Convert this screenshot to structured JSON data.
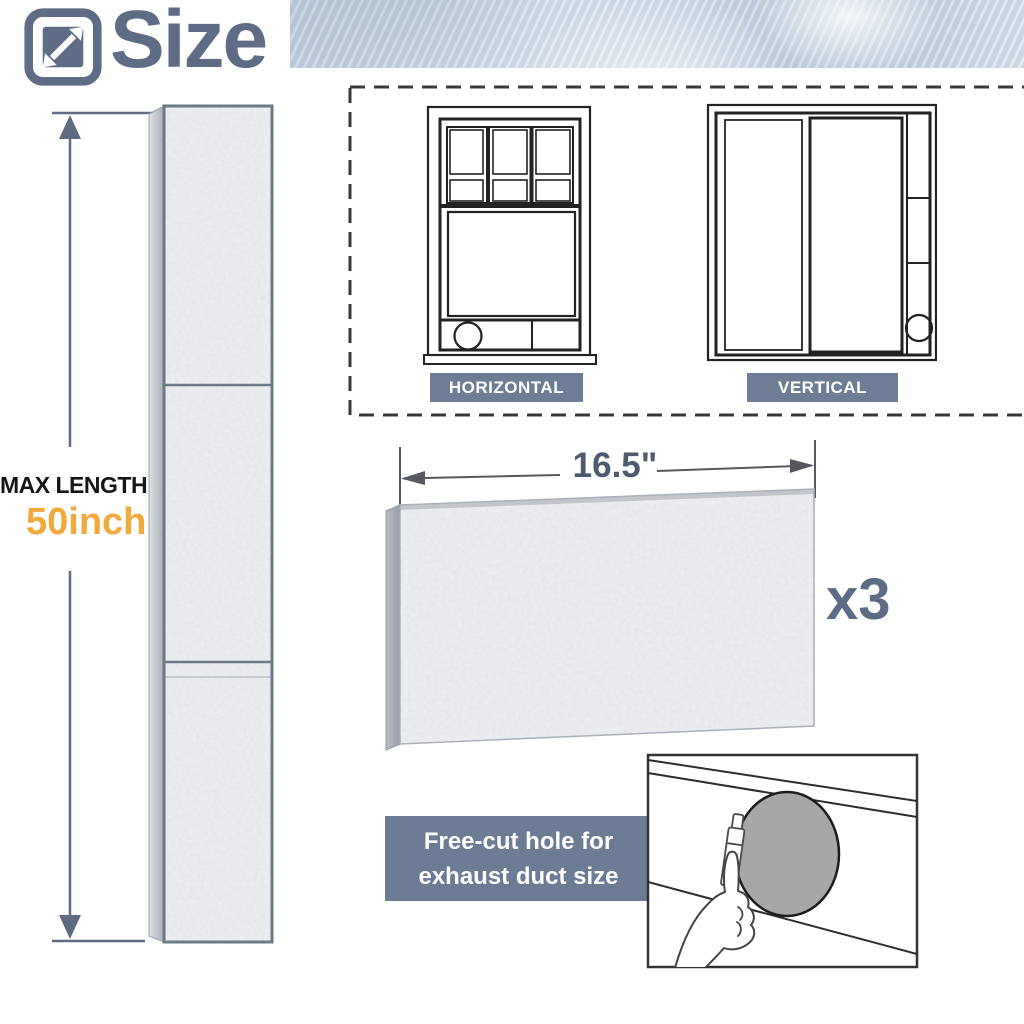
{
  "header": {
    "title": "Size",
    "icon": "resize-diagonal-icon"
  },
  "left_dimension": {
    "label": "MAX LENGTH:",
    "value": "50inch"
  },
  "window_types": {
    "horizontal": "HORIZONTAL",
    "vertical": "VERTICAL"
  },
  "panel": {
    "width": "16.5\"",
    "quantity": "x3"
  },
  "free_cut_note": {
    "line1": "Free-cut hole for",
    "line2": "exhaust duct size"
  },
  "colors": {
    "slate": "#5e6c86",
    "label_bg": "#6e7d96",
    "accent_orange": "#f1a93c",
    "foam_base": "#eef0f2"
  }
}
